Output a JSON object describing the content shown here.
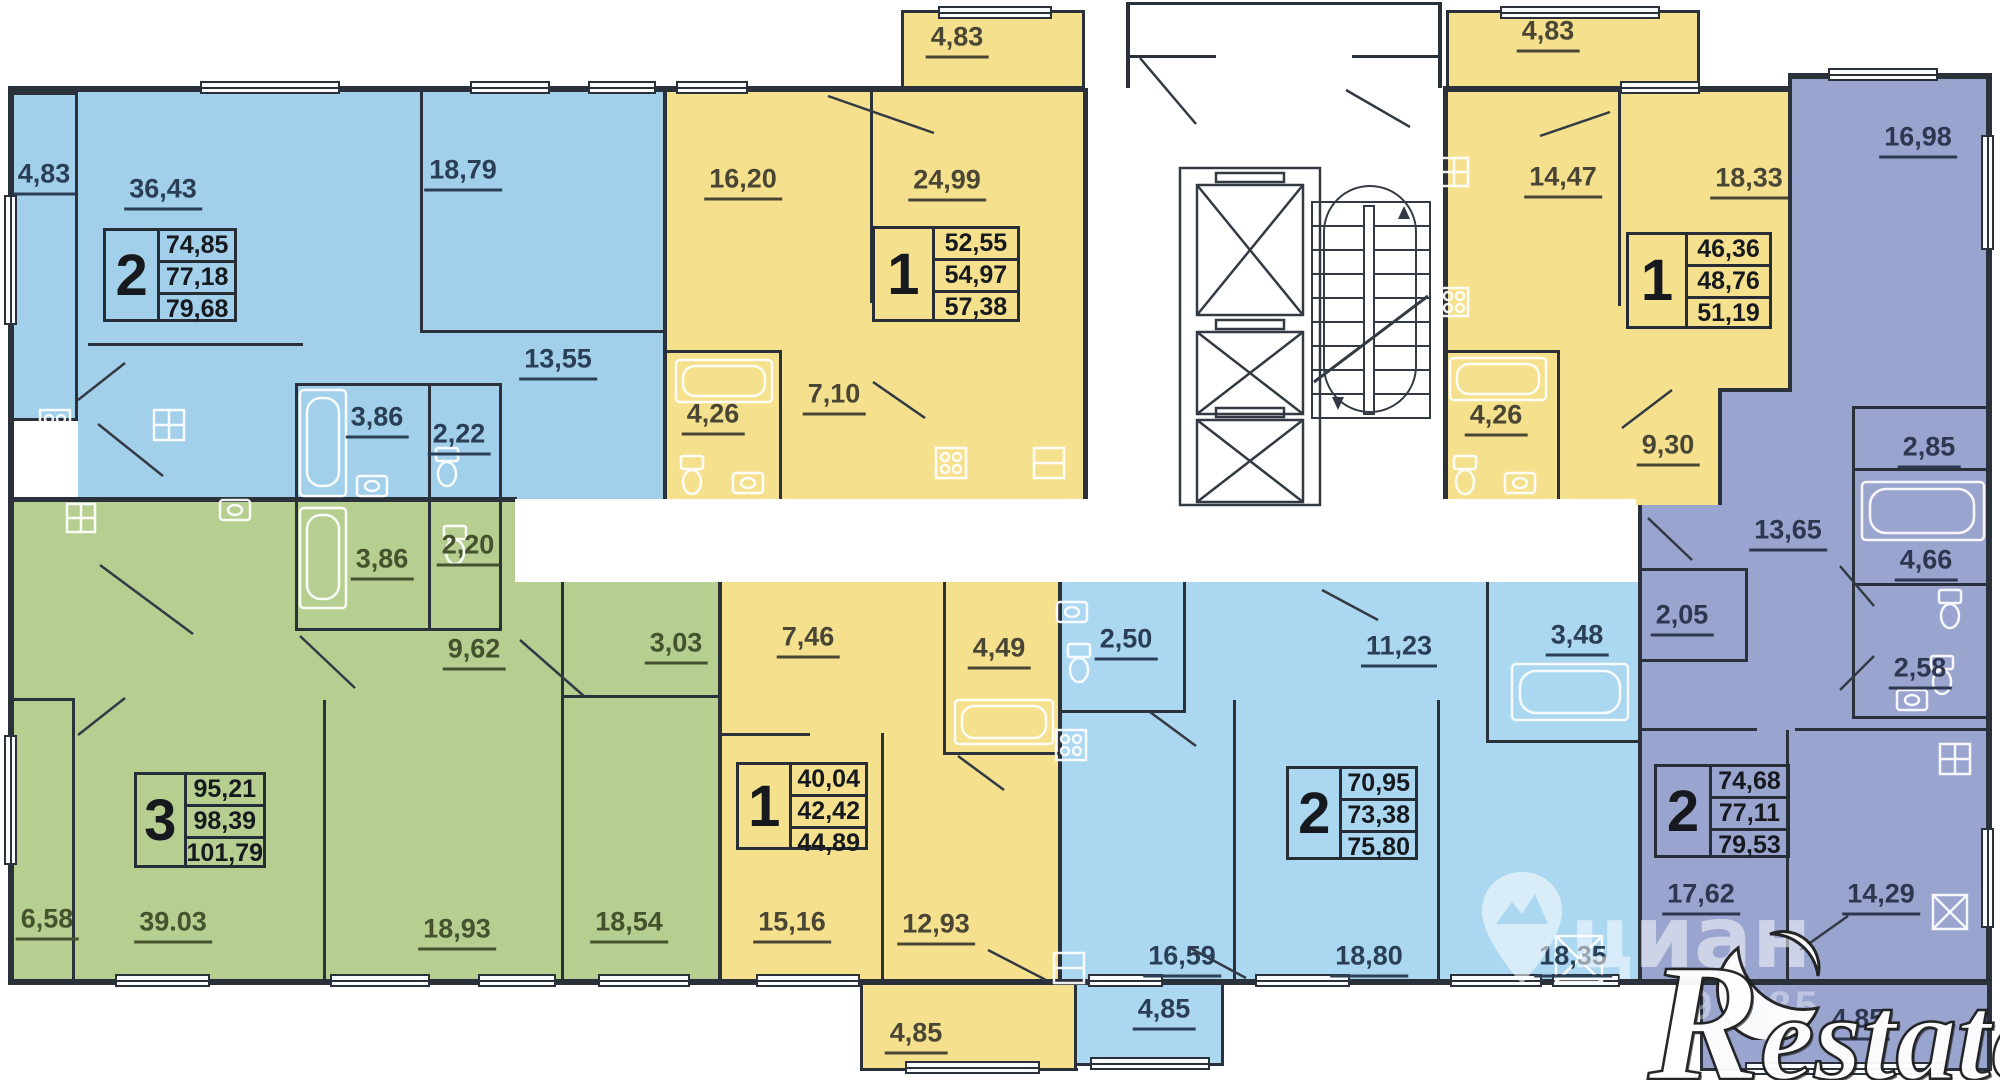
{
  "apartments": {
    "top_left_2": {
      "rooms_count": "2",
      "area_living": "74,85",
      "area_total": "77,18",
      "area_full": "79,68",
      "rooms": {
        "balcony": "4,83",
        "living": "36,43",
        "bedroom": "18,79",
        "kitchen": "13,55",
        "bath": "3,86",
        "wc": "2,22"
      }
    },
    "top_mid_1": {
      "rooms_count": "1",
      "area_living": "52,55",
      "area_total": "54,97",
      "area_full": "57,38",
      "rooms": {
        "balcony": "4,83",
        "room": "16,20",
        "living": "24,99",
        "bath": "4,26",
        "hall": "7,10"
      }
    },
    "top_right_1": {
      "rooms_count": "1",
      "area_living": "46,36",
      "area_total": "48,76",
      "area_full": "51,19",
      "rooms": {
        "balcony": "4,83",
        "room": "14,47",
        "living": "18,33",
        "bath": "4,26",
        "hall": "9,30"
      }
    },
    "right_2": {
      "rooms_count": "2",
      "area_living": "74,68",
      "area_total": "77,11",
      "area_full": "79,53",
      "rooms": {
        "room1": "16,98",
        "storage": "2,85",
        "hall": "13,65",
        "bath": "4,66",
        "closet": "2,05",
        "wc": "2,58",
        "room2": "17,62",
        "kitchen": "14,29",
        "balcony": "4,85"
      }
    },
    "bottom_left_3": {
      "rooms_count": "3",
      "area_living": "95,21",
      "area_total": "98,39",
      "area_full": "101,79",
      "rooms": {
        "bath": "3,86",
        "wc": "2,20",
        "hall": "9,62",
        "storage": "3,03",
        "balcony": "6,58",
        "living": "39.03",
        "room1": "18,93",
        "room2": "18,54"
      }
    },
    "bottom_mid_1": {
      "rooms_count": "1",
      "area_living": "40,04",
      "area_total": "42,42",
      "area_full": "44,89",
      "rooms": {
        "hall": "7,46",
        "bath": "4,49",
        "room": "15,16",
        "kitchen": "12,93",
        "balcony": "4,85"
      }
    },
    "bottom_right_2": {
      "rooms_count": "2",
      "area_living": "70,95",
      "area_total": "73,38",
      "area_full": "75,80",
      "rooms": {
        "wc": "2,50",
        "hall": "11,23",
        "bath": "3,48",
        "room1": "16,59",
        "living": "18,80",
        "kitchen": "18,35",
        "balcony": "4,85"
      }
    }
  },
  "watermarks": {
    "cian_text": "циан",
    "cian_id": "ID 73897785",
    "restate_text": "Restate"
  },
  "colors": {
    "blue": "#A2CFEA",
    "blue_light": "#ABD7F0",
    "yellow": "#F5E18D",
    "green": "#B7CE91",
    "purple": "#99A4CF",
    "wall": "#2A313A"
  }
}
